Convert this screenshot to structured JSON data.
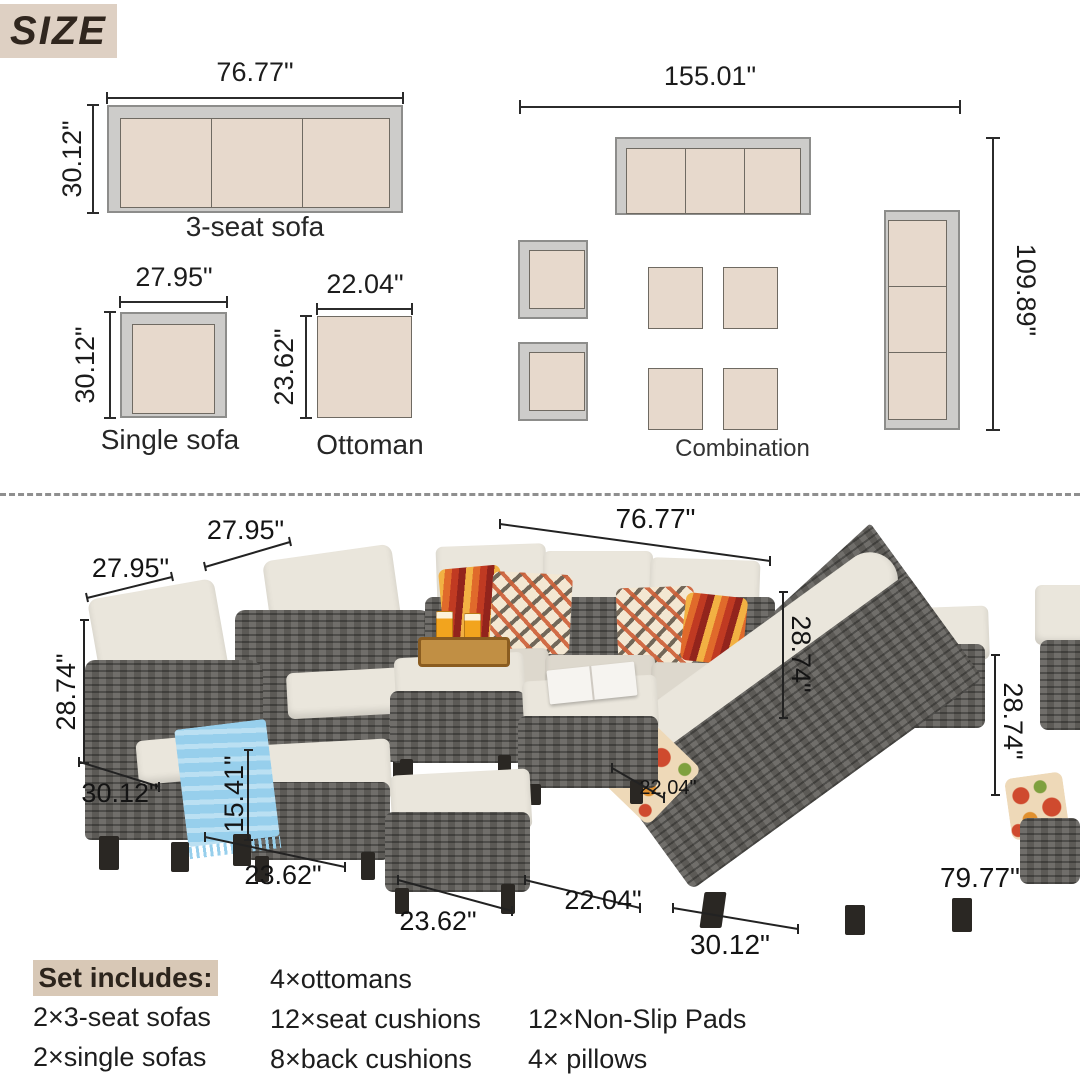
{
  "badge": {
    "text": "SIZE"
  },
  "diagrams": {
    "sofa3": {
      "name": "3-seat sofa",
      "width": "76.77\"",
      "depth": "30.12\""
    },
    "single": {
      "name": "Single sofa",
      "width": "27.95\"",
      "depth": "30.12\""
    },
    "ottoman": {
      "name": "Ottoman",
      "width": "22.04\"",
      "depth": "23.62\""
    },
    "combination": {
      "name": "Combination",
      "width": "155.01\"",
      "depth": "109.89\""
    }
  },
  "photo": {
    "chair1_width": "27.95\"",
    "chair2_width": "27.95\"",
    "sofa_width": "76.77\"",
    "seat_height_left": "28.74\"",
    "chair_depth": "30.12\"",
    "ottoman_height": "15.41\"",
    "ottoman_depth": "23.62\"",
    "ottoman_width": "23.62\"",
    "ottoman_side": "22.04\"",
    "ottoman_side2": "22.04\"",
    "sofa_height": "28.74\"",
    "sofa2_height": "28.74\"",
    "sofa2_length": "79.77\"",
    "sofa2_depth": "30.12\""
  },
  "set_includes": {
    "heading": "Set includes:",
    "col1": [
      "2×3-seat sofas",
      "2×single sofas"
    ],
    "col2": [
      "4×ottomans",
      "12×seat cushions",
      "8×back cushions"
    ],
    "col3": [
      "12×Non-Slip Pads",
      "4× pillows"
    ]
  },
  "colors": {
    "cushion_beige": "#e7d9cc",
    "frame_gray": "#cdccca",
    "badge_bg": "#ded0c3",
    "wicker_gray": "#5c5a56",
    "photo_cushion": "#eae6dc",
    "blanket_blue": "#97cfec",
    "accent_orange": "#e06a2b"
  }
}
